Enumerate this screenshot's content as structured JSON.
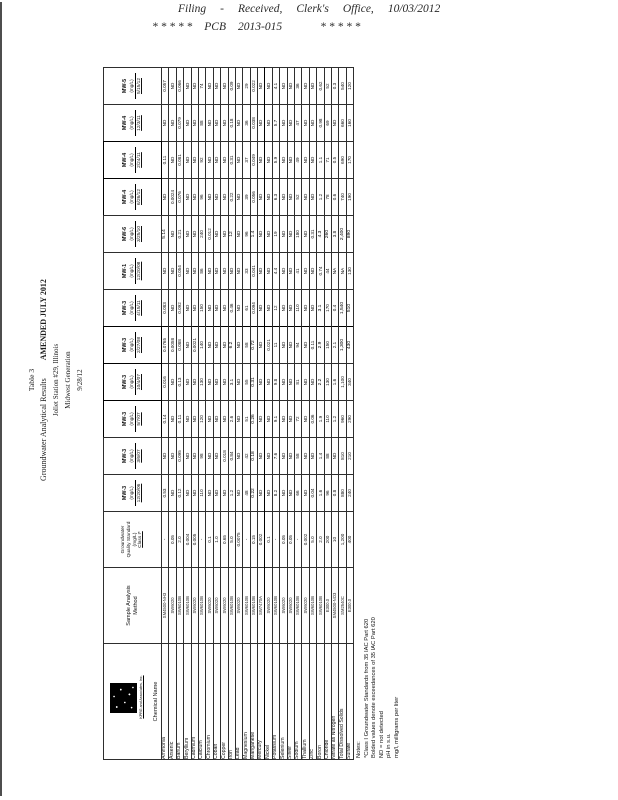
{
  "filing_stamp": {
    "line1_parts": [
      "Filing",
      "-",
      "Received,",
      "Clerk's",
      "Office,",
      "10/03/2012"
    ],
    "line2_parts": [
      "* * * * *",
      "PCB",
      "2013-015",
      "* * * * *"
    ]
  },
  "document": {
    "title": {
      "line1": "Table 3",
      "line2": "Groundwater Analytical Results",
      "amended": "AMENDED JULY 2012",
      "line3": "Joliet Station #29, Illinois",
      "line4": "Midwest Generation",
      "line5": "9/28/12"
    },
    "logo_company": "KPRG and Associates, Inc.",
    "table": {
      "corner_header": "Chemical Name",
      "method_header_lines": [
        "Sample Analysis",
        "Method"
      ],
      "standard_header_lines": [
        "Groundwater",
        "Quality Standard",
        "(mg/L)",
        "Class I*"
      ],
      "samples": [
        {
          "well": "MW-3",
          "unit": "(mg/L)",
          "date": "12/20/06",
          "boxed": false
        },
        {
          "well": "MW-3",
          "unit": "(mg/L)",
          "date": "3/6/07",
          "boxed": false
        },
        {
          "well": "MW-3",
          "unit": "(mg/L)",
          "date": "5/7/07",
          "boxed": true
        },
        {
          "well": "MW-3",
          "unit": "(mg/L)",
          "date": "10/4/07",
          "boxed": true
        },
        {
          "well": "MW-3",
          "unit": "(mg/L)",
          "date": "2/27/08",
          "boxed": true
        },
        {
          "well": "MW-3",
          "unit": "(mg/L)",
          "date": "4/15/11",
          "boxed": false
        },
        {
          "well": "MW-1",
          "unit": "(mg/L)",
          "date": "12/20/08",
          "boxed": false
        },
        {
          "well": "MW-6",
          "unit": "(mg/L)",
          "date": "3/25/10",
          "boxed": false
        },
        {
          "well": "MW-4",
          "unit": "(mg/L)",
          "date": "6/26/12",
          "boxed": true
        },
        {
          "well": "MW-4",
          "unit": "(mg/L)",
          "date": "2/24/11",
          "boxed": true
        },
        {
          "well": "MW-4",
          "unit": "(mg/L)",
          "date": "12/3/11",
          "boxed": false
        },
        {
          "well": "MW-5",
          "unit": "(mg/L)",
          "date": "5/15/12",
          "boxed": false
        }
      ],
      "bold_note": "values prefixed with ! are rendered bold (exceedances)",
      "parameters": [
        {
          "name": "Ammonia",
          "method": "SM4500-NH3",
          "standard": "-",
          "values": [
            "0.53",
            "ND",
            "0.14",
            "0.016",
            "0.0765",
            "0.083",
            "ND",
            "!5.14",
            "ND",
            "0.11",
            "ND",
            "0.057"
          ]
        },
        {
          "name": "Arsenic",
          "method": "SW6020",
          "standard": "0.05",
          "values": [
            "ND",
            "ND",
            "ND",
            "ND",
            "0.0058",
            "ND",
            "ND",
            "ND",
            "0.0024",
            "ND",
            "ND",
            "ND"
          ]
        },
        {
          "name": "Barium",
          "method": "SW6010B",
          "standard": "2.0",
          "values": [
            "0.12",
            "0.095",
            "0.11",
            "0.13",
            "0.088",
            "0.092",
            "0.054",
            "0.21",
            "0.076",
            "0.081",
            "0.079",
            "0.066"
          ]
        },
        {
          "name": "Beryllium",
          "method": "SW6010B",
          "standard": "0.004",
          "values": [
            "ND",
            "ND",
            "ND",
            "ND",
            "ND",
            "ND",
            "ND",
            "ND",
            "ND",
            "ND",
            "ND",
            "ND"
          ]
        },
        {
          "name": "Cadmium",
          "method": "SW6020",
          "standard": "0.005",
          "values": [
            "ND",
            "ND",
            "ND",
            "ND",
            "0.0021",
            "ND",
            "ND",
            "ND",
            "ND",
            "ND",
            "ND",
            "ND"
          ]
        },
        {
          "name": "Calcium",
          "method": "SW6010B",
          "standard": "-",
          "values": [
            "110",
            "98",
            "120",
            "130",
            "140",
            "150",
            "86",
            "240",
            "96",
            "92",
            "88",
            "74"
          ]
        },
        {
          "name": "Chromium",
          "method": "SW6020",
          "standard": "0.1",
          "values": [
            "ND",
            "ND",
            "ND",
            "ND",
            "ND",
            "ND",
            "ND",
            "0.012",
            "ND",
            "ND",
            "ND",
            "ND"
          ]
        },
        {
          "name": "Cobalt",
          "method": "SW6020",
          "standard": "1.0",
          "values": [
            "ND",
            "ND",
            "ND",
            "ND",
            "ND",
            "ND",
            "ND",
            "ND",
            "ND",
            "ND",
            "ND",
            "ND"
          ]
        },
        {
          "name": "Copper",
          "method": "SW6020",
          "standard": "0.65",
          "values": [
            "ND",
            "0.018",
            "ND",
            "ND",
            "ND",
            "ND",
            "ND",
            "ND",
            "ND",
            "ND",
            "ND",
            "ND"
          ]
        },
        {
          "name": "Iron",
          "method": "SW6010B",
          "standard": "5.0",
          "values": [
            "1.2",
            "0.84",
            "2.6",
            "3.1",
            "!6.2",
            "0.46",
            "ND",
            "!12",
            "0.22",
            "0.31",
            "0.18",
            "0.09"
          ]
        },
        {
          "name": "Lead",
          "method": "SW6020",
          "standard": "0.0075",
          "values": [
            "ND",
            "ND",
            "ND",
            "ND",
            "ND",
            "ND",
            "ND",
            "ND",
            "ND",
            "ND",
            "ND",
            "ND"
          ]
        },
        {
          "name": "Magnesium",
          "method": "SW6010B",
          "standard": "-",
          "values": [
            "48",
            "42",
            "51",
            "55",
            "58",
            "61",
            "33",
            "96",
            "39",
            "37",
            "36",
            "29"
          ]
        },
        {
          "name": "Manganese",
          "method": "SW6010B",
          "standard": "0.15",
          "values": [
            "!0.22",
            "!0.18",
            "!0.26",
            "!0.31",
            "!0.72",
            "0.094",
            "0.041",
            "!1.4",
            "0.056",
            "0.049",
            "0.038",
            "0.022"
          ]
        },
        {
          "name": "Mercury",
          "method": "SW7470A",
          "standard": "0.002",
          "values": [
            "ND",
            "ND",
            "ND",
            "ND",
            "ND",
            "ND",
            "ND",
            "ND",
            "ND",
            "ND",
            "ND",
            "ND"
          ]
        },
        {
          "name": "Nickel",
          "method": "SW6020",
          "standard": "0.1",
          "values": [
            "ND",
            "ND",
            "ND",
            "ND",
            "0.021",
            "ND",
            "ND",
            "ND",
            "ND",
            "ND",
            "ND",
            "ND"
          ]
        },
        {
          "name": "Potassium",
          "method": "SW6010B",
          "standard": "-",
          "values": [
            "8.2",
            "7.6",
            "9.1",
            "9.8",
            "11",
            "12",
            "4.4",
            "19",
            "6.3",
            "5.9",
            "5.7",
            "4.1"
          ]
        },
        {
          "name": "Selenium",
          "method": "SW6020",
          "standard": "0.05",
          "values": [
            "ND",
            "ND",
            "ND",
            "ND",
            "ND",
            "ND",
            "ND",
            "ND",
            "ND",
            "ND",
            "ND",
            "ND"
          ]
        },
        {
          "name": "Silver",
          "method": "SW6020",
          "standard": "0.05",
          "values": [
            "ND",
            "ND",
            "ND",
            "ND",
            "ND",
            "ND",
            "ND",
            "ND",
            "ND",
            "ND",
            "ND",
            "ND"
          ]
        },
        {
          "name": "Sodium",
          "method": "SW6010B",
          "standard": "-",
          "values": [
            "66",
            "58",
            "72",
            "81",
            "94",
            "110",
            "41",
            "180",
            "52",
            "49",
            "47",
            "36"
          ]
        },
        {
          "name": "Thallium",
          "method": "SW6020",
          "standard": "0.002",
          "values": [
            "ND",
            "ND",
            "ND",
            "ND",
            "ND",
            "ND",
            "ND",
            "ND",
            "ND",
            "ND",
            "ND",
            "ND"
          ]
        },
        {
          "name": "Zinc",
          "method": "SW6010B",
          "standard": "5.0",
          "values": [
            "0.04",
            "ND",
            "0.06",
            "ND",
            "0.11",
            "ND",
            "ND",
            "0.31",
            "ND",
            "ND",
            "ND",
            "ND"
          ]
        },
        {
          "name": "Boron",
          "method": "SW6010B",
          "standard": "2.0",
          "values": [
            "1.6",
            "1.4",
            "1.9",
            "!2.2",
            "!2.9",
            "!3.1",
            "0.74",
            "!4.3",
            "1.2",
            "1.1",
            "0.98",
            "0.62"
          ]
        },
        {
          "name": "Chloride",
          "method": "E300.0",
          "standard": "200",
          "values": [
            "96",
            "88",
            "110",
            "130",
            "150",
            "170",
            "44",
            "!260",
            "78",
            "71",
            "69",
            "52"
          ]
        },
        {
          "name": "Nitrate as Nitrogen",
          "method": "SM4500-NO3",
          "standard": "10",
          "values": [
            "0.8",
            "ND",
            "1.2",
            "1.6",
            "2.1",
            "0.4",
            "NA",
            "3.8",
            "0.6",
            "0.5",
            "ND",
            "0.3"
          ]
        },
        {
          "name": "Total Dissolved Solids",
          "method": "SM2540C",
          "standard": "1,200",
          "values": [
            "880",
            "810",
            "960",
            "1,100",
            "!1,300",
            "!1,540",
            "NA",
            "!2,400",
            "740",
            "690",
            "660",
            "540"
          ]
        },
        {
          "name": "Sulfate",
          "method": "E300.0",
          "standard": "400",
          "values": [
            "240",
            "210",
            "290",
            "340",
            "!430",
            "!510",
            "130",
            "!890",
            "190",
            "170",
            "160",
            "120"
          ]
        }
      ],
      "thick_column_after_sample_index": 5,
      "thick_row_after_parameter": "Mercury"
    },
    "notes": [
      "Notes:",
      "*Class I Groundwater Standards from 35 IAC Part 620",
      "Bolded values denote exceedances of 35 IAC Part 620",
      "ND = not detected",
      "pH in s.u.",
      "mg/l, milligrams per liter"
    ]
  }
}
